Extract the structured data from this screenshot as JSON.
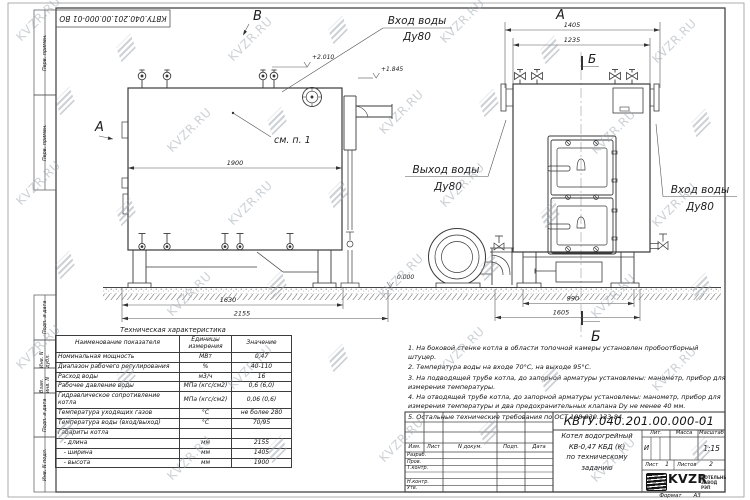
{
  "sheet": {
    "top_stamp": "КВТУ.040.201.00.000-01 ВО",
    "format_label": "Формат",
    "format_value": "А3",
    "margin_labels": [
      "Перв. примен.",
      "Перв. примен.",
      "Подп. и дата",
      "Инв. N дубл.",
      "Взам. инв. N",
      "Подп. и дата",
      "Инв. N подл."
    ]
  },
  "watermark": {
    "text": "KVZR.RU"
  },
  "drawing": {
    "view_a": "А",
    "view_b": "Б",
    "view_v": "В",
    "see_note": "см. п. 1",
    "inlet": "Вход воды",
    "outlet": "Выход воды",
    "dn": "Ду80",
    "elev_top": "+2.010",
    "elev_flue": "+1.845",
    "elev_zero": "0.000",
    "dims": {
      "d1900": "1900",
      "d1630": "1630",
      "d2155": "2155",
      "d1405": "1405",
      "d1235": "1235",
      "d990": "990",
      "d1605": "1605"
    }
  },
  "spec_table": {
    "title": "Техническая характеристика",
    "headers": [
      "Наименование показателя",
      "Единицы измерения",
      "Значение"
    ],
    "rows": [
      [
        "Номинальная мощность",
        "МВт",
        "0,47"
      ],
      [
        "Диапазон рабочего регулирования",
        "%",
        "40-110"
      ],
      [
        "Расход воды",
        "м3/ч",
        "16"
      ],
      [
        "Рабочее давление воды",
        "МПа (кгс/см2)",
        "0,6 (6,0)"
      ],
      [
        "Гидравлическое сопротивление котла",
        "МПа (кгс/см2)",
        "0,06 (0,6)"
      ],
      [
        "Температура уходящих газов",
        "°С",
        "не более 280"
      ],
      [
        "Температура воды (вход/выход)",
        "°С",
        "70/95"
      ],
      [
        "Габариты котла",
        "",
        ""
      ],
      [
        "   - длина",
        "мм",
        "2155"
      ],
      [
        "   - ширина",
        "мм",
        "1405"
      ],
      [
        "   - высота",
        "мм",
        "1900"
      ]
    ]
  },
  "notes": [
    "1. На боковой стенке котла в области топочной камеры установлен пробоотборный штуцер.",
    "2. Температура воды на входе 70°С, на выходе 95°С.",
    "3. На подводящей трубе котла, до запорной арматуры установлены: манометр, прибор для измерения температуры.",
    "4. На отводящей трубе котла, до запорной арматуры установлены: манометр, прибор для измерения температуры и два предохранительных клапана Dу не менее 40 мм.",
    "5. Остальные технические требования по ОСТ 108.030.133-84."
  ],
  "title_block": {
    "doc_number": "КВТУ.040.201.00.000-01 ВО",
    "product_lines": [
      "Котел водогрейный",
      "КВ-0,47 КБД (К)",
      "по техническому заданию"
    ],
    "cols": [
      "Изм.",
      "Лист",
      "N докум.",
      "Подп.",
      "Дата"
    ],
    "rows": [
      "Разраб.",
      "Пров.",
      "Т.контр.",
      "",
      "Н.контр.",
      "Утв."
    ],
    "lit_label": "Лит.",
    "lit_value": "И",
    "mass_label": "Масса",
    "mass_value": "",
    "scale_label": "Масштаб",
    "scale_value": "1:15",
    "sheet_label": "Лист",
    "sheet_value": "1",
    "sheets_label": "Листов",
    "sheets_value": "2",
    "company": {
      "logo": "KVZR",
      "line1": "КОТЕЛЬНЫЙ",
      "line2": "ЗАВОД РЭП"
    }
  }
}
